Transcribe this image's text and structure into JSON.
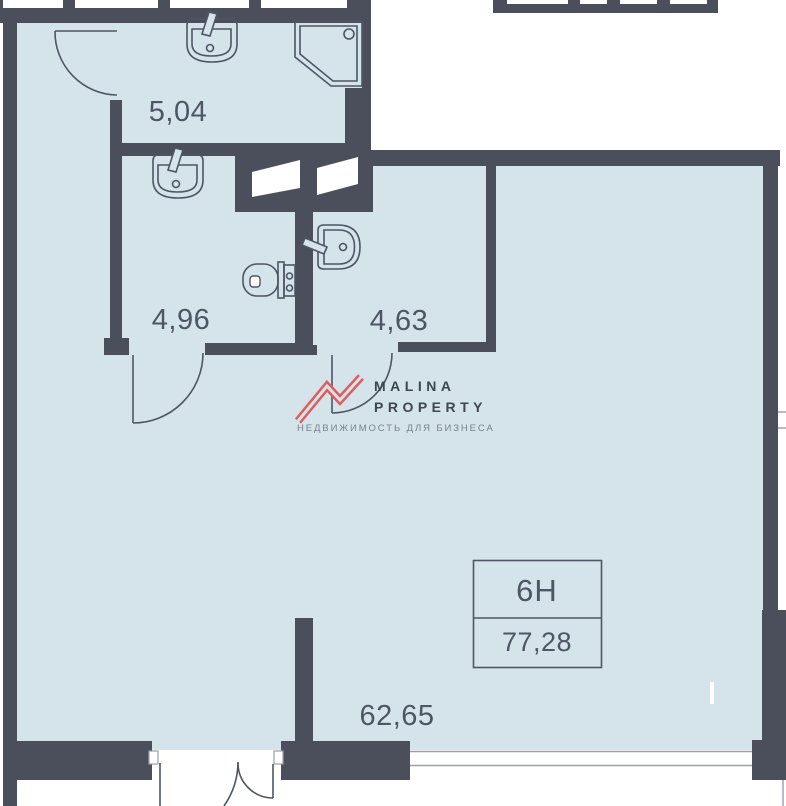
{
  "plan": {
    "unit_number": "6Н",
    "unit_total_area": "77,28",
    "room_areas": {
      "top_bathroom": "5,04",
      "left_bathroom": "4,96",
      "right_bathroom": "4,63",
      "main_room": "62,65"
    },
    "fixtures": [
      "sink",
      "shower",
      "sink",
      "toilet",
      "sink"
    ]
  },
  "watermark": {
    "brand_line1": "MALINA",
    "brand_line2": "PROPERTY",
    "tagline": "НЕДВИЖИМОСТЬ ДЛЯ БИЗНЕСА"
  },
  "colors": {
    "wall": "#4a4f5b",
    "floor": "#d5e3ea",
    "line": "#4e5565",
    "logo_accent": "#e05d5d",
    "logo_text": "#3f4551",
    "tagline_text": "#7b818c",
    "window_line": "#9aa0a8"
  }
}
